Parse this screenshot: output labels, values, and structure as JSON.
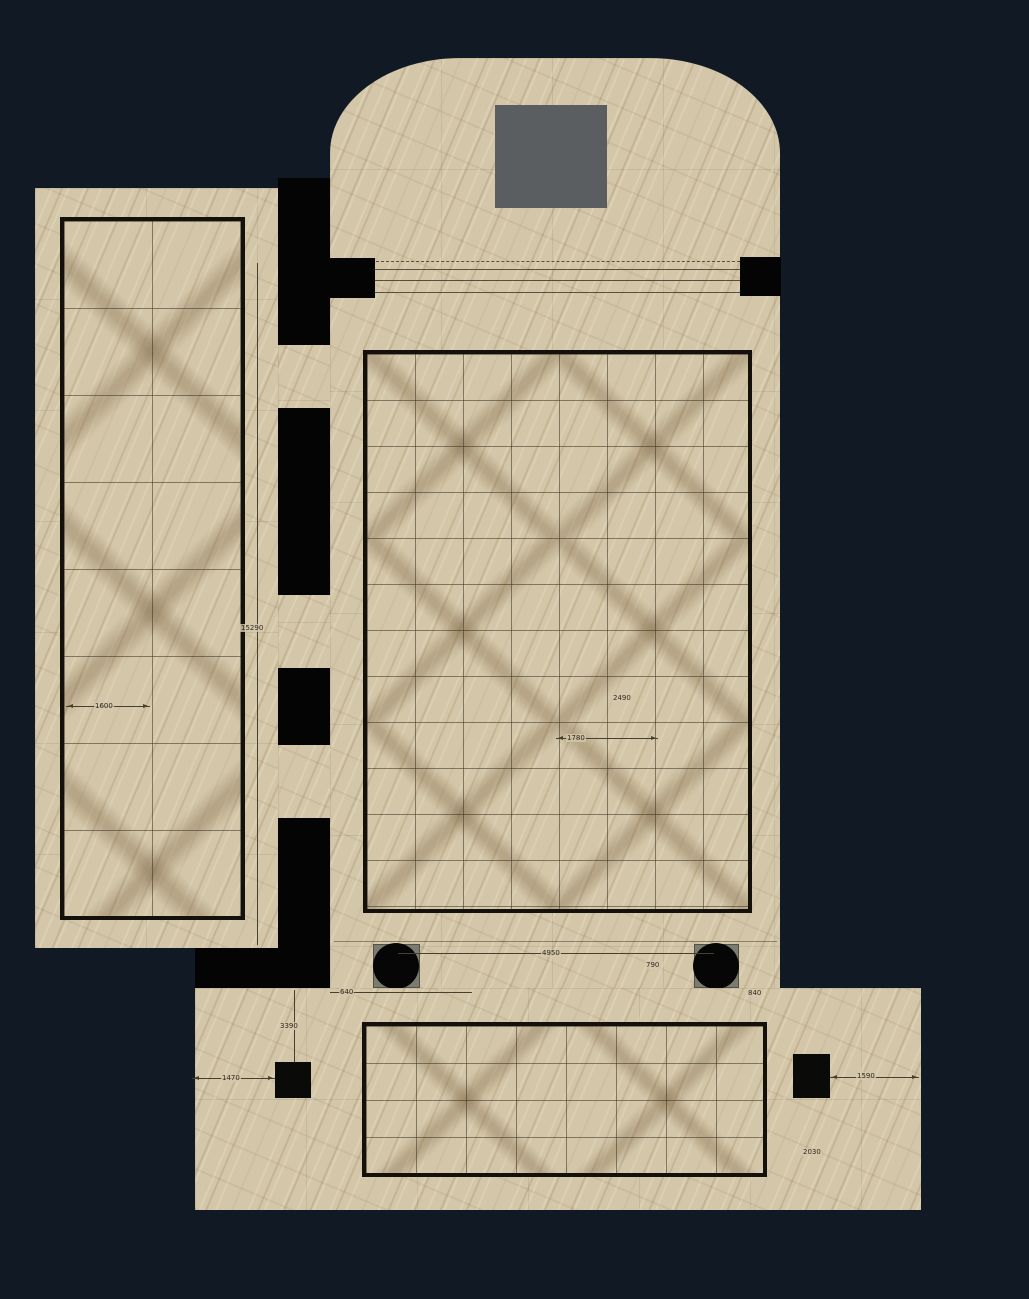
{
  "scene": {
    "name": "marble floor plan rendering",
    "background_color": "#111a24",
    "marble_color": "#d4c7a9",
    "vein_color": "#826844",
    "wall_color": "#040404",
    "altar_block_color": "#5a5e61",
    "column_color": "#060606",
    "column_base_color": "#7c7b6f",
    "tile_border_color": "#14110c"
  },
  "regions": {
    "left_gallery": "left gallery floor",
    "corridor": "corridor doorways",
    "apse": "apse with rounded end",
    "main_hall": "main hall tile field",
    "vestibule": "lower vestibule tile field"
  },
  "dims": {
    "gallery_length": "15290",
    "gallery_tile": "1600",
    "hall_tile_diag": "2490",
    "hall_tile_width": "1780",
    "column_span": "4950",
    "column_offset": "790",
    "step_left": "640",
    "step_right": "840",
    "porch_depth": "3390",
    "pier_left_offset": "1470",
    "pier_right_offset": "1590",
    "porch_width": "2030"
  }
}
